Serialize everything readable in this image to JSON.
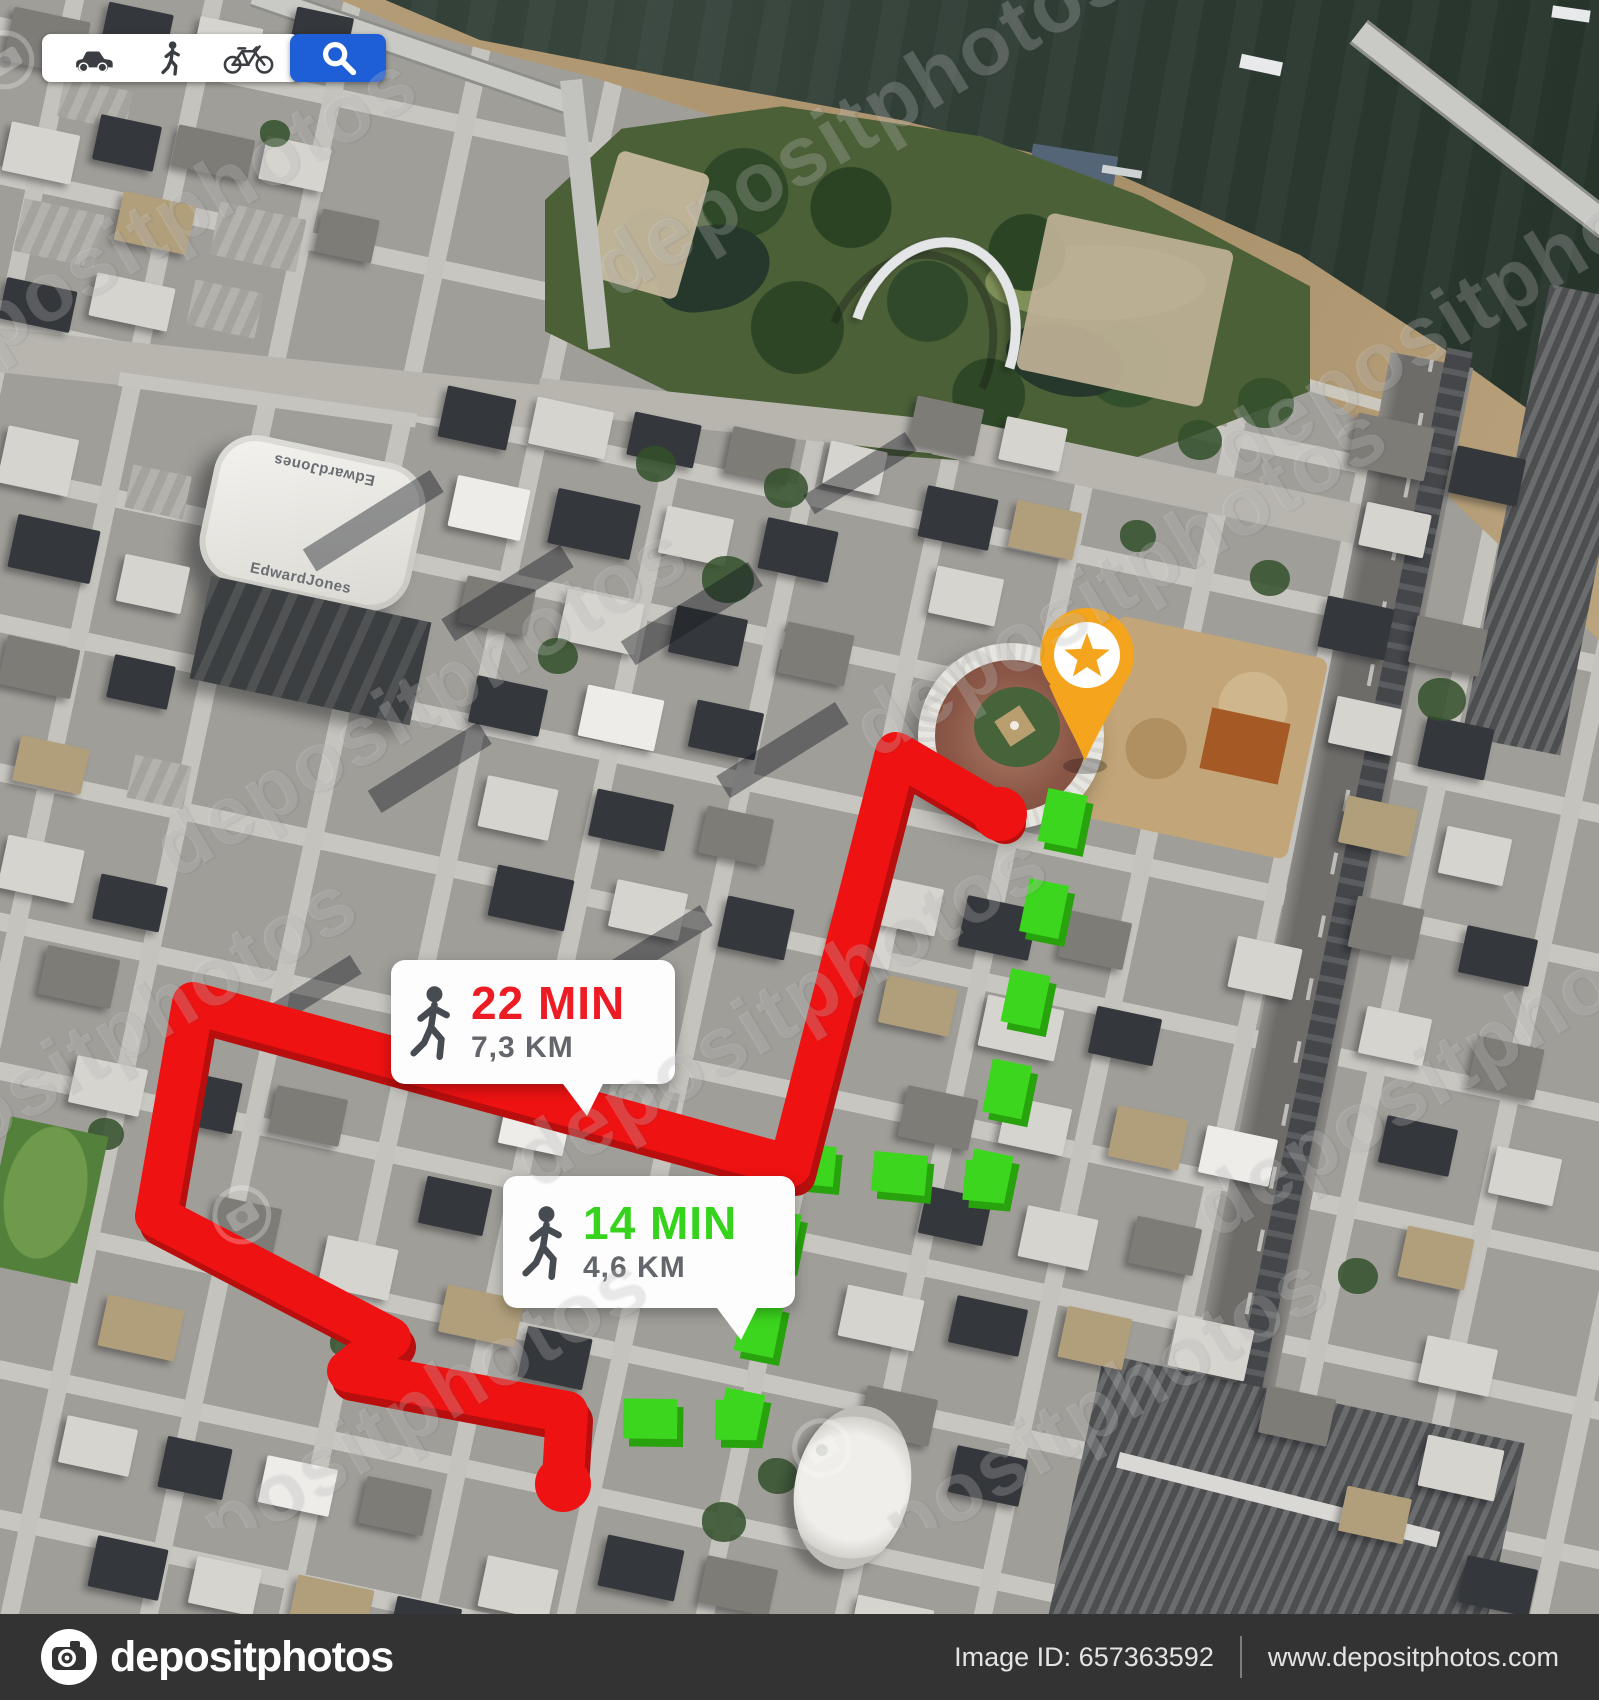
{
  "toolbar": {
    "icons": [
      "car-icon",
      "pedestrian-icon",
      "bicycle-icon",
      "search-icon"
    ],
    "accent_blue": "#1E5ED6"
  },
  "pin": {
    "icon": "star-pin-icon",
    "color": "#F4A51D"
  },
  "routes": {
    "long": {
      "mode_icon": "walking-person-icon",
      "time": "22 MIN",
      "distance": "7,3 KM",
      "color": "#EE1212",
      "style": "solid"
    },
    "short": {
      "mode_icon": "walking-person-icon",
      "time": "14 MIN",
      "distance": "4,6 KM",
      "color": "#3CD61E",
      "style": "dashed"
    }
  },
  "map": {
    "dome_roof_label": "EdwardJones"
  },
  "watermark": {
    "text": "depositphotos"
  },
  "footer": {
    "brand": "depositphotos",
    "image_id": "Image ID: 657363592",
    "website": "www.depositphotos.com"
  }
}
